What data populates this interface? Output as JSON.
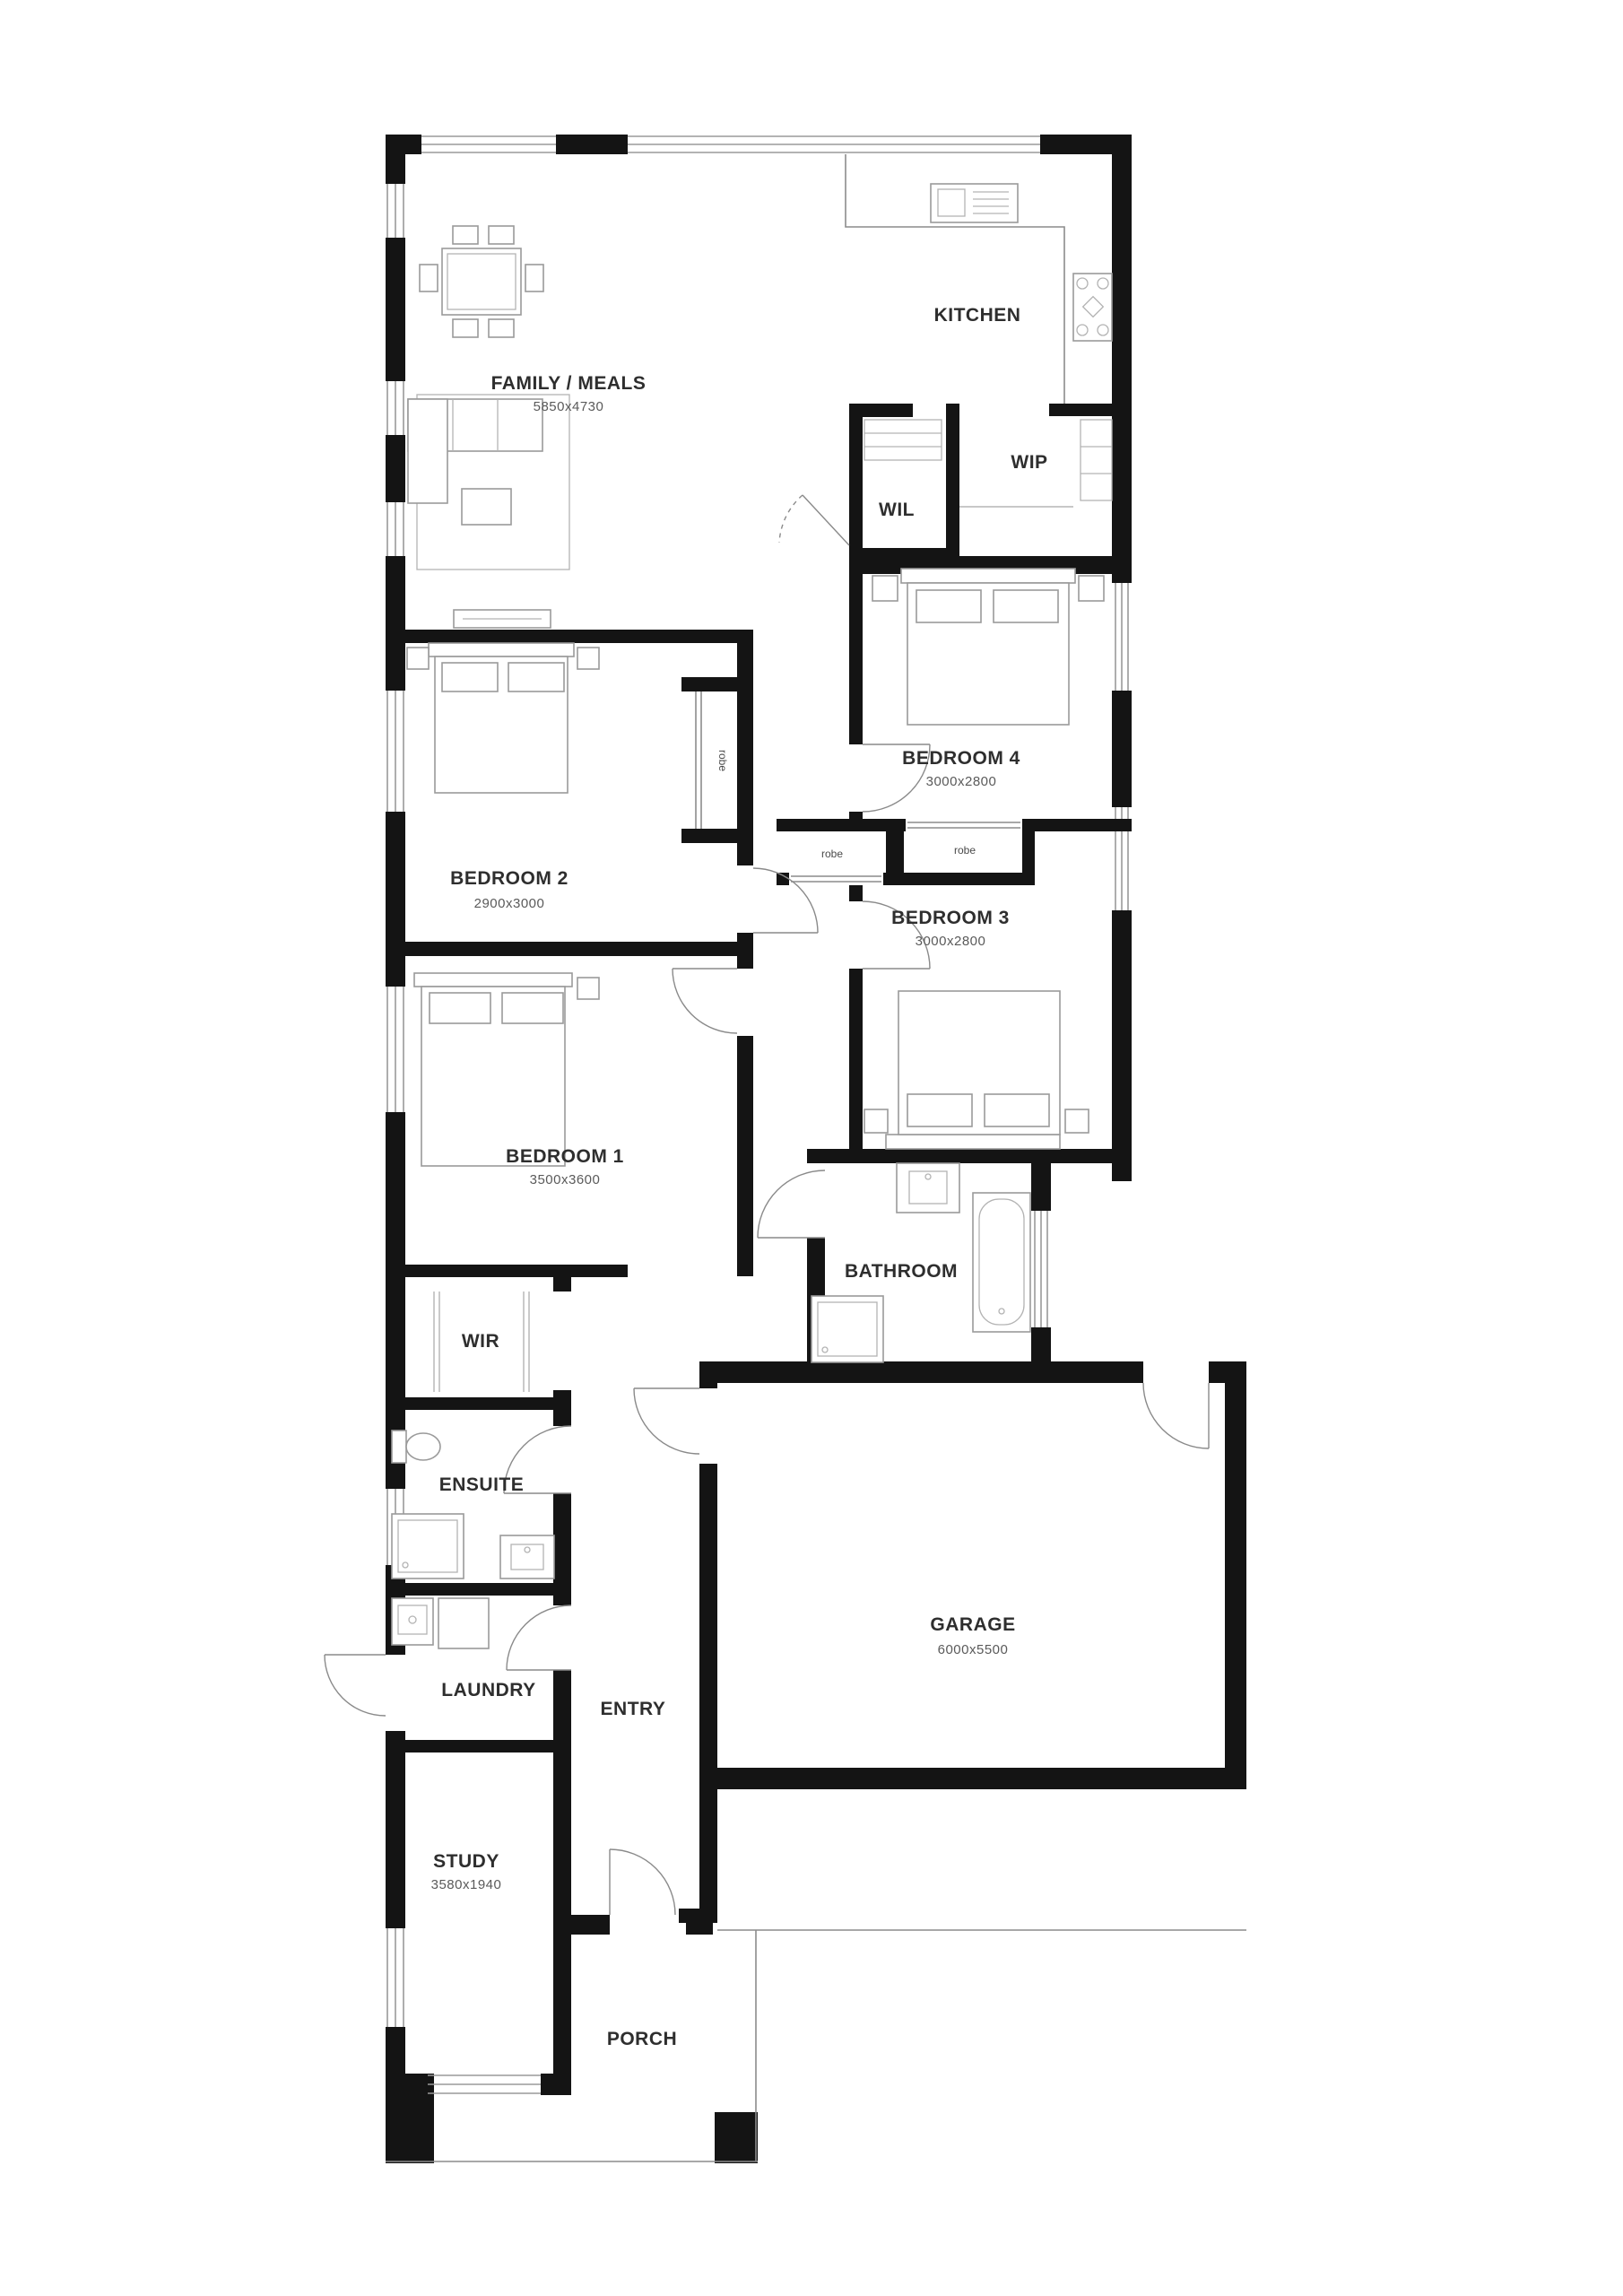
{
  "plan": {
    "rooms": {
      "family": {
        "label": "FAMILY / MEALS",
        "dims": "5850x4730"
      },
      "kitchen": {
        "label": "KITCHEN"
      },
      "wip": {
        "label": "WIP"
      },
      "wil": {
        "label": "WIL"
      },
      "bedroom4": {
        "label": "BEDROOM 4",
        "dims": "3000x2800"
      },
      "bedroom3": {
        "label": "BEDROOM 3",
        "dims": "3000x2800"
      },
      "bedroom2": {
        "label": "BEDROOM 2",
        "dims": "2900x3000"
      },
      "bedroom1": {
        "label": "BEDROOM 1",
        "dims": "3500x3600"
      },
      "bathroom": {
        "label": "BATHROOM"
      },
      "wir": {
        "label": "WIR"
      },
      "ensuite": {
        "label": "ENSUITE"
      },
      "laundry": {
        "label": "LAUNDRY"
      },
      "entry": {
        "label": "ENTRY"
      },
      "garage": {
        "label": "GARAGE",
        "dims": "6000x5500"
      },
      "study": {
        "label": "STUDY",
        "dims": "3580x1940"
      },
      "porch": {
        "label": "PORCH"
      },
      "robe_left": {
        "label": "robe"
      },
      "robe_right": {
        "label": "robe"
      },
      "robe_bed2": {
        "label": "robe"
      }
    },
    "colors": {
      "wall": "#141414",
      "line": "#8c8c8c",
      "label": "#2e2e2e",
      "dim": "#5a5a5a"
    }
  }
}
